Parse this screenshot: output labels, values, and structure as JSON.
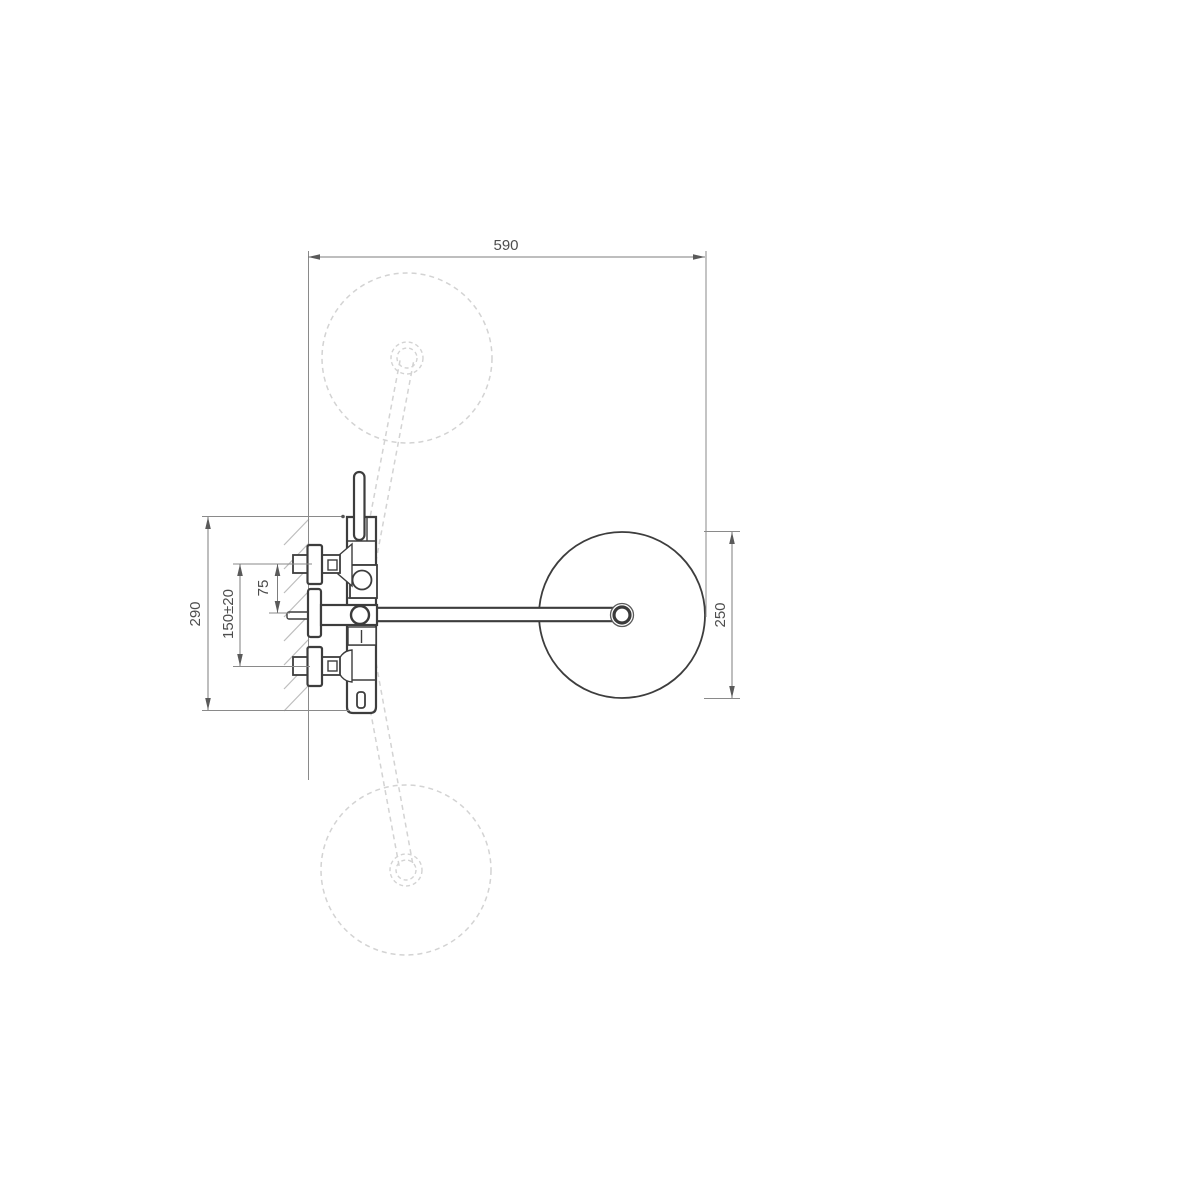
{
  "drawing": {
    "title": "Wall-mounted shower mixer installation drawing, side view",
    "dimensions": {
      "span_wall_to_head": "590",
      "body_height": "290",
      "inlet_spacing": "150±20",
      "outlet_to_inlet": "75",
      "head_diameter": "250"
    },
    "colors": {
      "solid_line": "#3d3d3d",
      "dimension_line": "#7d7d7d",
      "phantom_line": "#d3d3d3",
      "background": "#ffffff"
    }
  }
}
